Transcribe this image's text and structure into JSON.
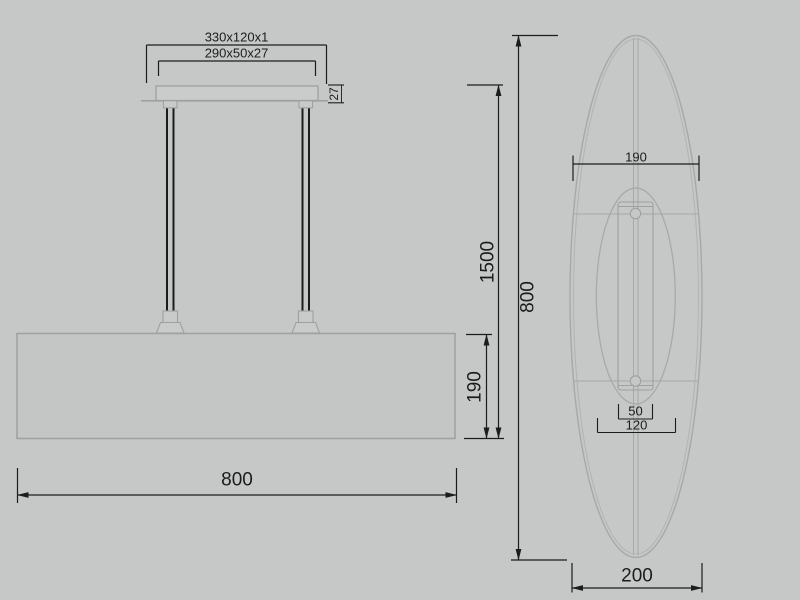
{
  "colors": {
    "background": "#c6c7c7",
    "object_line": "#9ea1a1",
    "light_line": "#a8abab",
    "dimension": "#1c1c1c"
  },
  "front_view": {
    "plate_dim": "330x120x1",
    "canopy_dim": "290x50x27",
    "canopy_height": "27",
    "drop_height": "1500",
    "shade_height": "190",
    "shade_width": "800"
  },
  "side_view": {
    "upper_width": "190",
    "overall_length": "800",
    "bracket_width": "50",
    "opening_width": "120",
    "overall_depth": "200"
  }
}
